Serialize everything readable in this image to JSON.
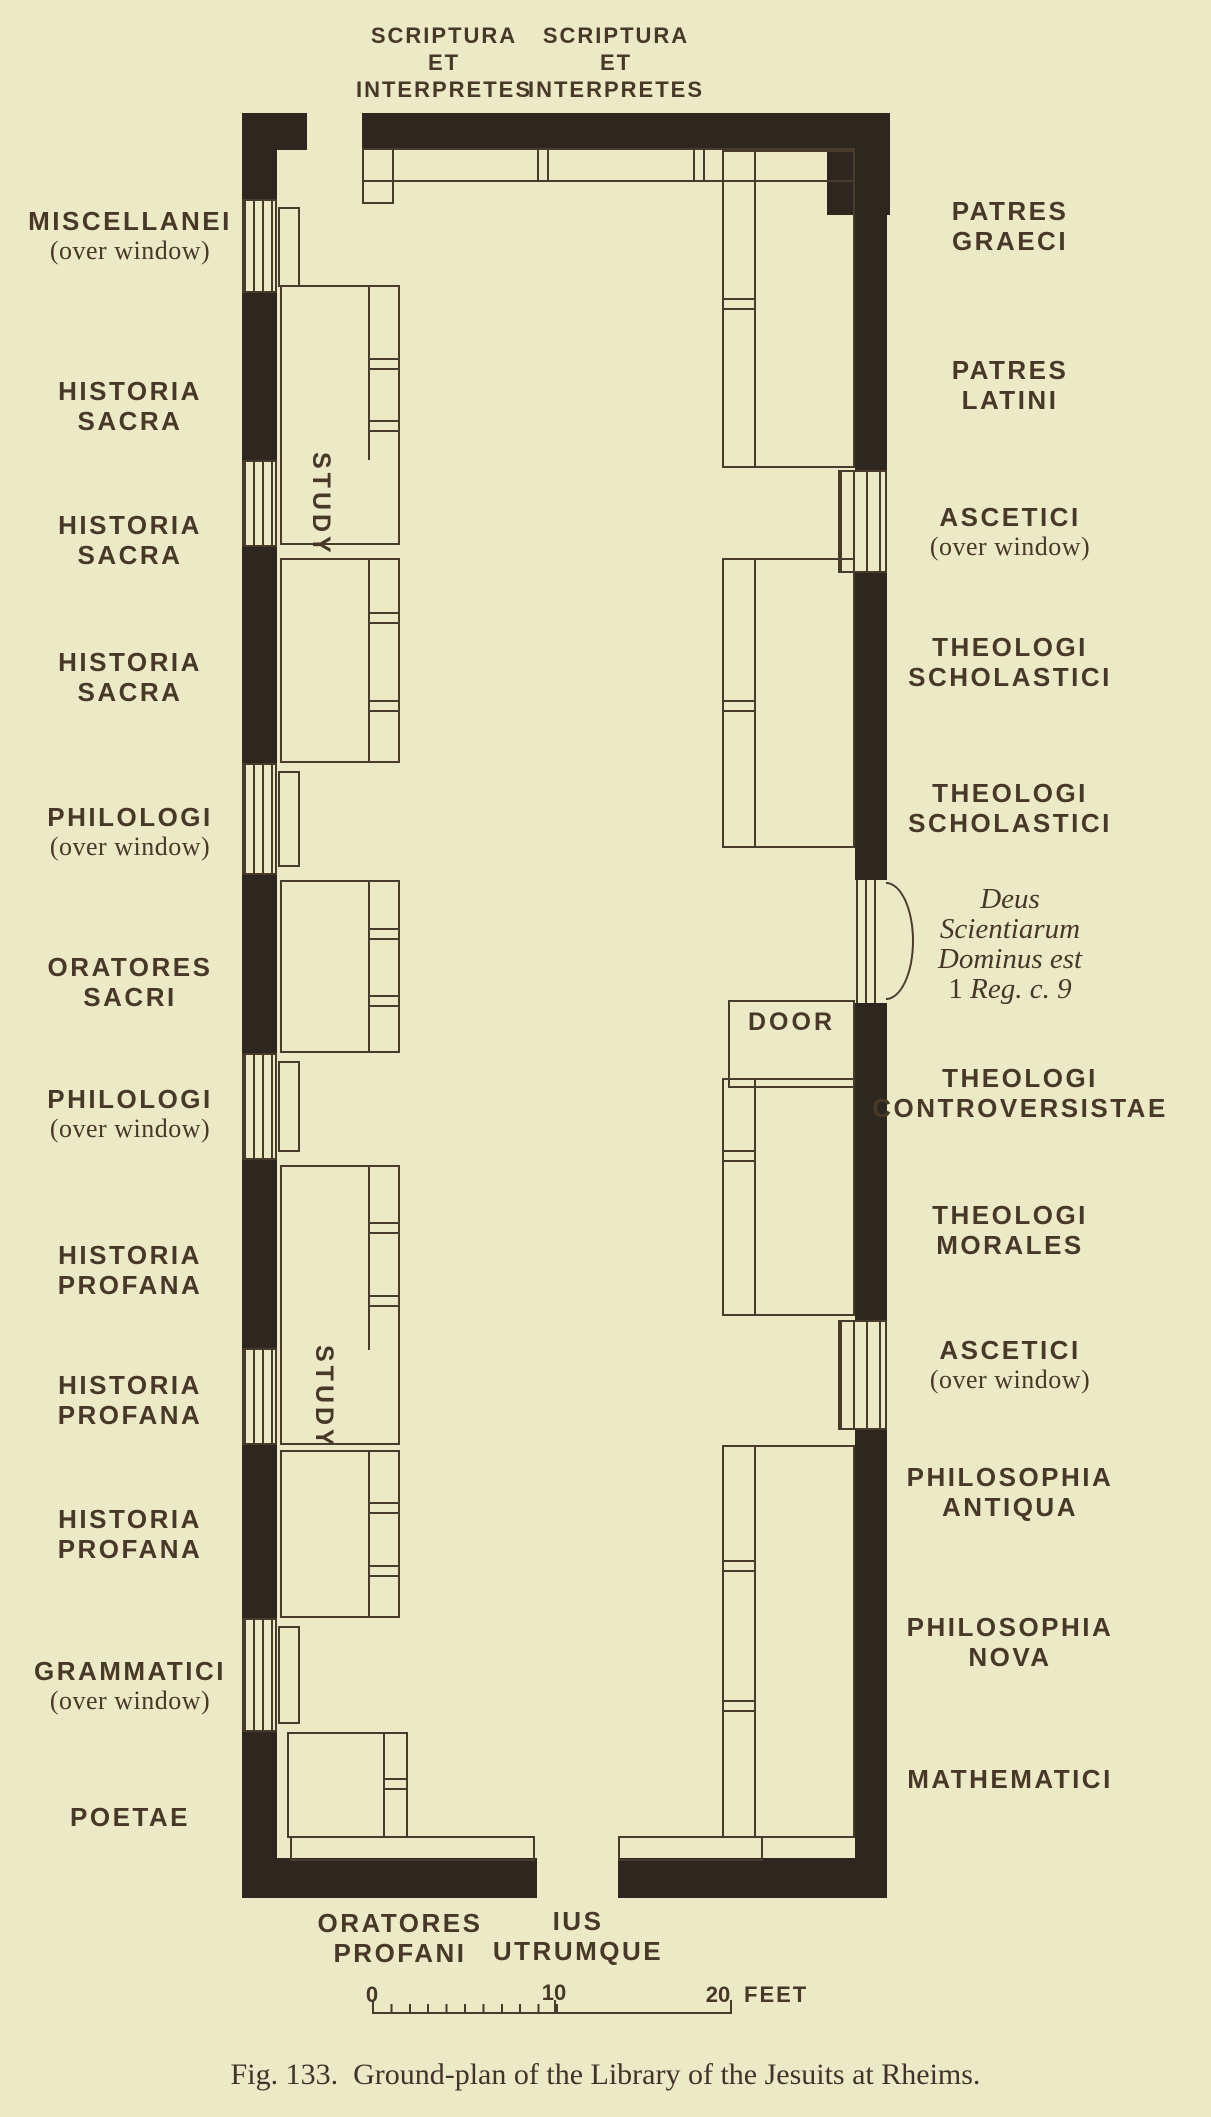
{
  "figure": {
    "caption": "Fig. 133.  Ground-plan of the Library of the Jesuits at Rheims.",
    "colors": {
      "paper": "#ece9c6",
      "wall_ink": "#2d2720",
      "line_ink": "#4a3c2d",
      "text_ink": "#483828"
    }
  },
  "plan": {
    "top_labels": [
      {
        "l1": "SCRIPTURA",
        "l2": "ET",
        "l3": "INTERPRETES"
      },
      {
        "l1": "SCRIPTURA",
        "l2": "ET",
        "l3": "INTERPRETES"
      }
    ],
    "left_labels": [
      {
        "l1": "MISCELLANEI",
        "l2": "(over window)"
      },
      {
        "l1": "HISTORIA",
        "l2": "SACRA"
      },
      {
        "l1": "HISTORIA",
        "l2": "SACRA"
      },
      {
        "l1": "HISTORIA",
        "l2": "SACRA"
      },
      {
        "l1": "PHILOLOGI",
        "l2": "(over window)"
      },
      {
        "l1": "ORATORES",
        "l2": "SACRI"
      },
      {
        "l1": "PHILOLOGI",
        "l2": "(over window)"
      },
      {
        "l1": "HISTORIA",
        "l2": "PROFANA"
      },
      {
        "l1": "HISTORIA",
        "l2": "PROFANA"
      },
      {
        "l1": "HISTORIA",
        "l2": "PROFANA"
      },
      {
        "l1": "GRAMMATICI",
        "l2": "(over window)"
      },
      {
        "l1": "POETAE"
      }
    ],
    "right_labels": [
      {
        "l1": "PATRES",
        "l2": "GRAECI"
      },
      {
        "l1": "PATRES",
        "l2": "LATINI"
      },
      {
        "l1": "ASCETICI",
        "l2": "(over window)"
      },
      {
        "l1": "THEOLOGI",
        "l2": "SCHOLASTICI"
      },
      {
        "l1": "THEOLOGI",
        "l2": "SCHOLASTICI"
      },
      {
        "l1": "THEOLOGI",
        "l2": "CONTROVERSISTAE"
      },
      {
        "l1": "THEOLOGI",
        "l2": "MORALES"
      },
      {
        "l1": "ASCETICI",
        "l2": "(over window)"
      },
      {
        "l1": "PHILOSOPHIA",
        "l2": "ANTIQUA"
      },
      {
        "l1": "PHILOSOPHIA",
        "l2": "NOVA"
      },
      {
        "l1": "MATHEMATICI"
      }
    ],
    "bottom_labels": [
      {
        "l1": "ORATORES",
        "l2": "PROFANI"
      },
      {
        "l1": "IUS",
        "l2": "UTRUMQUE"
      }
    ],
    "study_label": "STUDY",
    "door_label": "DOOR",
    "inscription": {
      "l1": "Deus",
      "l2": "Scientiarum",
      "l3": "Dominus est",
      "l4a": "1",
      "l4b": " Reg. c. 9"
    },
    "scale": {
      "t0": "0",
      "t10": "10",
      "t20": "20",
      "unit": "FEET"
    }
  }
}
